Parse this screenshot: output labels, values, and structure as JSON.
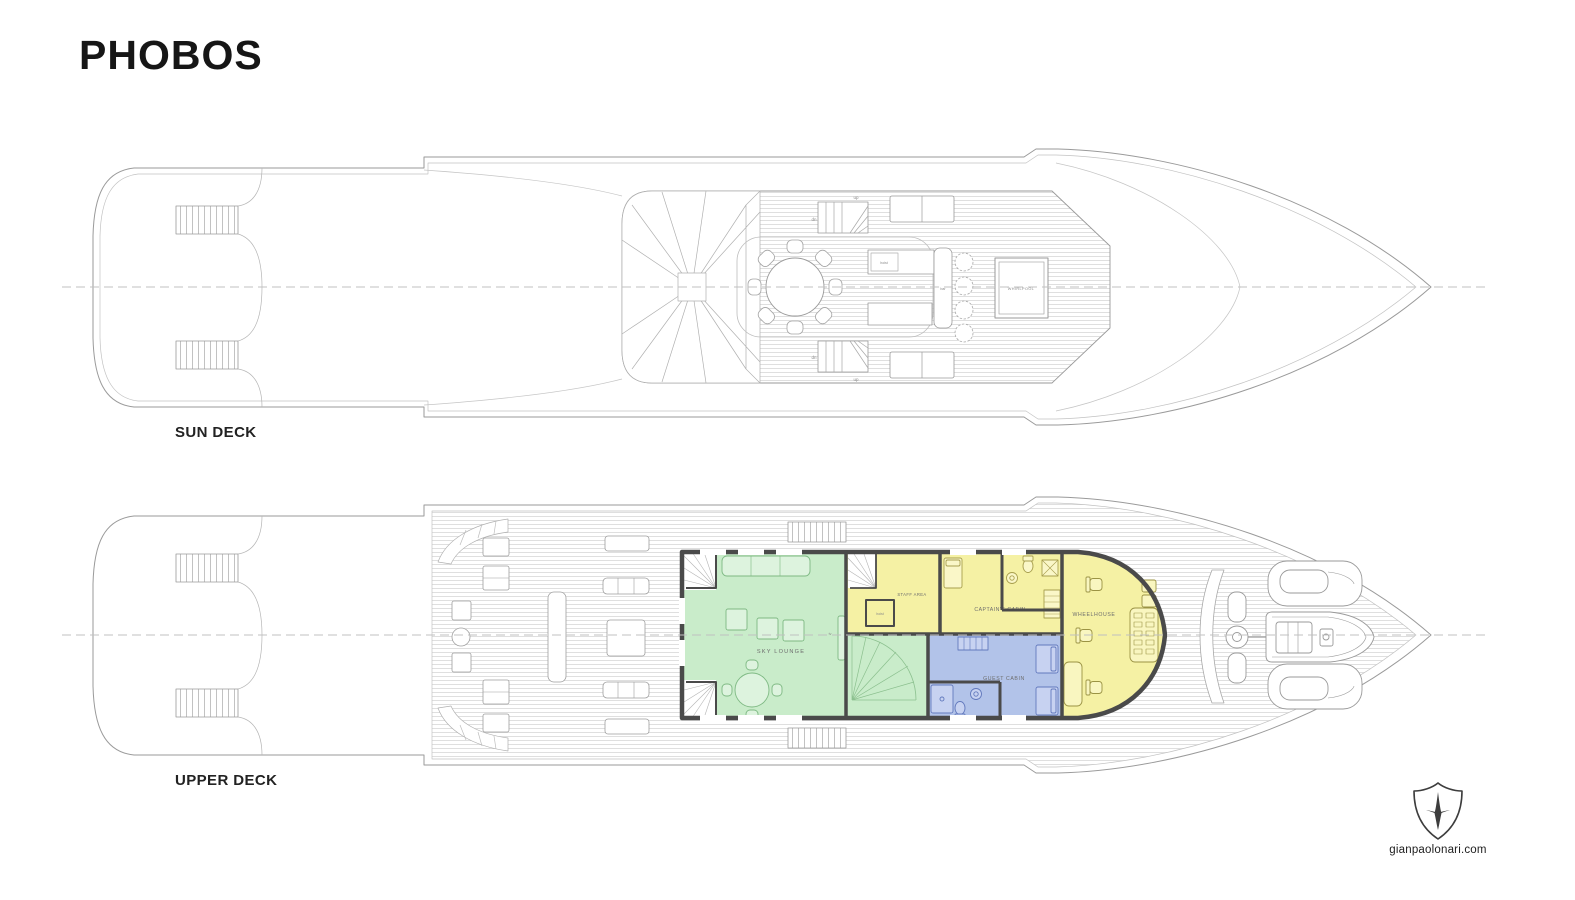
{
  "title": "PHOBOS",
  "sun_deck": {
    "label": "SUN DECK",
    "annotations": {
      "whirlpool": "WHIRLPOOL",
      "hoist": "hoist",
      "bar": "bar",
      "up": "up",
      "down": "dn"
    }
  },
  "upper_deck": {
    "label": "UPPER DECK",
    "rooms": {
      "sky_lounge": "SKY LOUNGE",
      "staff_area": "STAFF AREA",
      "captains_cabin": "CAPTAIN'S CABIN",
      "wheelhouse": "WHEELHOUSE",
      "guest_cabin": "GUEST CABIN"
    },
    "annotations": {
      "hoist": "hoist",
      "tv": "tv"
    }
  },
  "credit": {
    "website": "gianpaolonari.com",
    "logo_icon": "shield-star-icon"
  },
  "colors": {
    "lounge_green": "#c9ecca",
    "cabin_yellow": "#f5f1a4",
    "guest_blue": "#b2c3e9",
    "wall_gray": "#4a4a4a",
    "line_gray": "#9a9a9a",
    "centerline_gray": "#c0c0c0"
  }
}
